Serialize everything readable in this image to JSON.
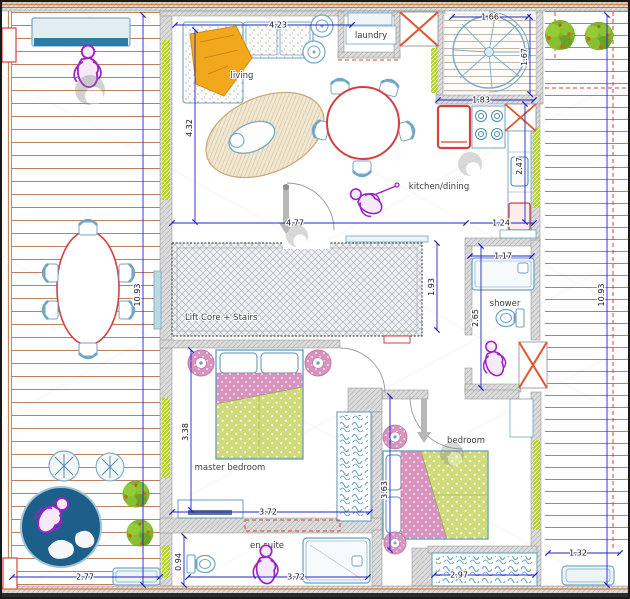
{
  "labels": {
    "living": "living",
    "laundry": "laundry",
    "kitchen_dining": "kitchen/dining",
    "lift_core": "Lift Core + Stairs",
    "master_bedroom": "master bedroom",
    "bedroom": "bedroom",
    "shower": "shower",
    "en_suite": "en suite"
  },
  "dims": {
    "living_width": "4.23",
    "living_height": "4.32",
    "stair_width": "1.66",
    "stair_height": "1.67",
    "kitchen_width": "1.83",
    "kitchen_depth": "2.47",
    "kitchen_bottom": "1.24",
    "hall_span": "4.77",
    "core_height": "1.93",
    "deck_left_height": "10.93",
    "deck_right_height": "10.93",
    "shower_width": "1.17",
    "shower_height": "2.65",
    "master_height": "3.38",
    "master_width": "3.72",
    "bedroom_height": "3.63",
    "ensuite_width": "3.72",
    "ensuite_height": "0.94",
    "wardrobe_width": "2.97",
    "bench_width": "1.32",
    "deck_bottom_width": "2.77"
  },
  "colors": {
    "dimension_blue": "#2424c6",
    "furniture_blue": "#6fa6c6",
    "accent_red": "#d64545",
    "duvet_green": "#cfda79",
    "pillow_pink": "#d893bf",
    "figure_purple": "#9b22c4",
    "plant_green": "#7cb42e",
    "window_green": "#b6d22e",
    "deck_plank": "#b5714f",
    "wall_grey": "#dcdcdc"
  }
}
